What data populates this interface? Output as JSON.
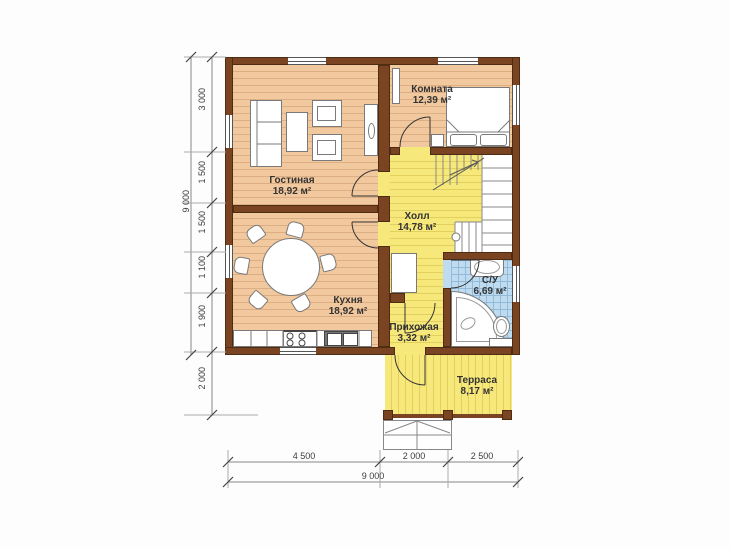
{
  "plan": {
    "type": "floor-plan",
    "rooms": [
      {
        "name": "Комната",
        "area": "12,39 м²"
      },
      {
        "name": "Гостиная",
        "area": "18,92 м²"
      },
      {
        "name": "Холл",
        "area": "14,78 м²"
      },
      {
        "name": "Кухня",
        "area": "18,92 м²"
      },
      {
        "name": "Прихожая",
        "area": "3,32 м²"
      },
      {
        "name": "С/У",
        "area": "6,69 м²"
      },
      {
        "name": "Терраса",
        "area": "8,17 м²"
      }
    ],
    "dimensions": {
      "left_total": "9 000",
      "left_segments": [
        "3 000",
        "1 500",
        "1 500",
        "1 100",
        "1 900",
        "2 000"
      ],
      "bottom_segments": [
        "4 500",
        "2 000",
        "2 500"
      ],
      "bottom_total": "9 000"
    }
  },
  "colors": {
    "wall": "#7a4423",
    "wall-outline": "#4e2c12",
    "wood": "#f2c89e",
    "wood-stripe": "#dcae83",
    "yellow": "#f7e87c",
    "yellow-stripe": "#e3cf5e",
    "tile": "#bedbf0",
    "tile-grid": "#94bad9",
    "text": "#333333"
  }
}
